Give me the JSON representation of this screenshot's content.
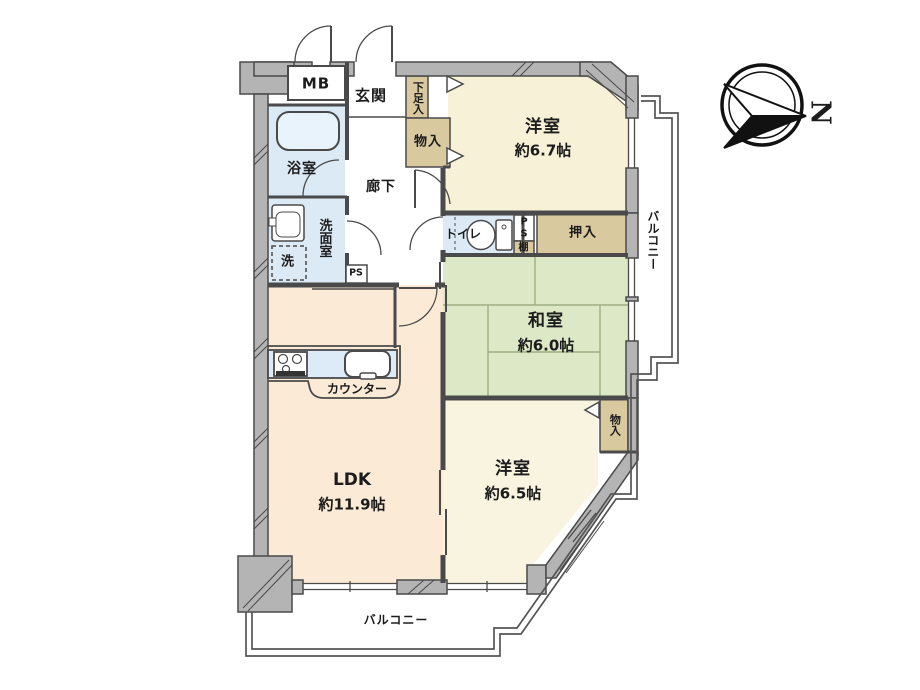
{
  "floorplan": {
    "compass": {
      "north": "N"
    },
    "rooms": {
      "western_ne": {
        "name": "洋室",
        "area": "約6.7帖"
      },
      "japanese": {
        "name": "和室",
        "area": "約6.0帖"
      },
      "western_s": {
        "name": "洋室",
        "area": "約6.5帖"
      },
      "ldk": {
        "name": "LDK",
        "area": "約11.9帖"
      },
      "entrance": "玄関",
      "hallway": "廊下",
      "bathroom": "浴室",
      "washroom": "洗面室",
      "toilet": "トイレ"
    },
    "balcony": {
      "right": "バルコニー",
      "bottom": "バルコニー"
    },
    "storage": {
      "shoe": "下足入",
      "entrance_closet": "物入",
      "oshiire": "押入",
      "south_closet": "物入",
      "shelf": "棚"
    },
    "utility": {
      "meter_box": "MB",
      "ps": "PS",
      "ps_p": "P",
      "ps_s": "S",
      "laundry": "洗",
      "counter": "カウンター"
    },
    "colors": {
      "wall_fill": "#b4b4b4",
      "line": "#4a4a4a",
      "western_room": "#f7f1d7",
      "ldk_room": "#fbead5",
      "tatami": "#dde8c6",
      "closet": "#d9c99f",
      "water_area": "#dbeaf5",
      "counter_top": "#dcebf7"
    }
  }
}
